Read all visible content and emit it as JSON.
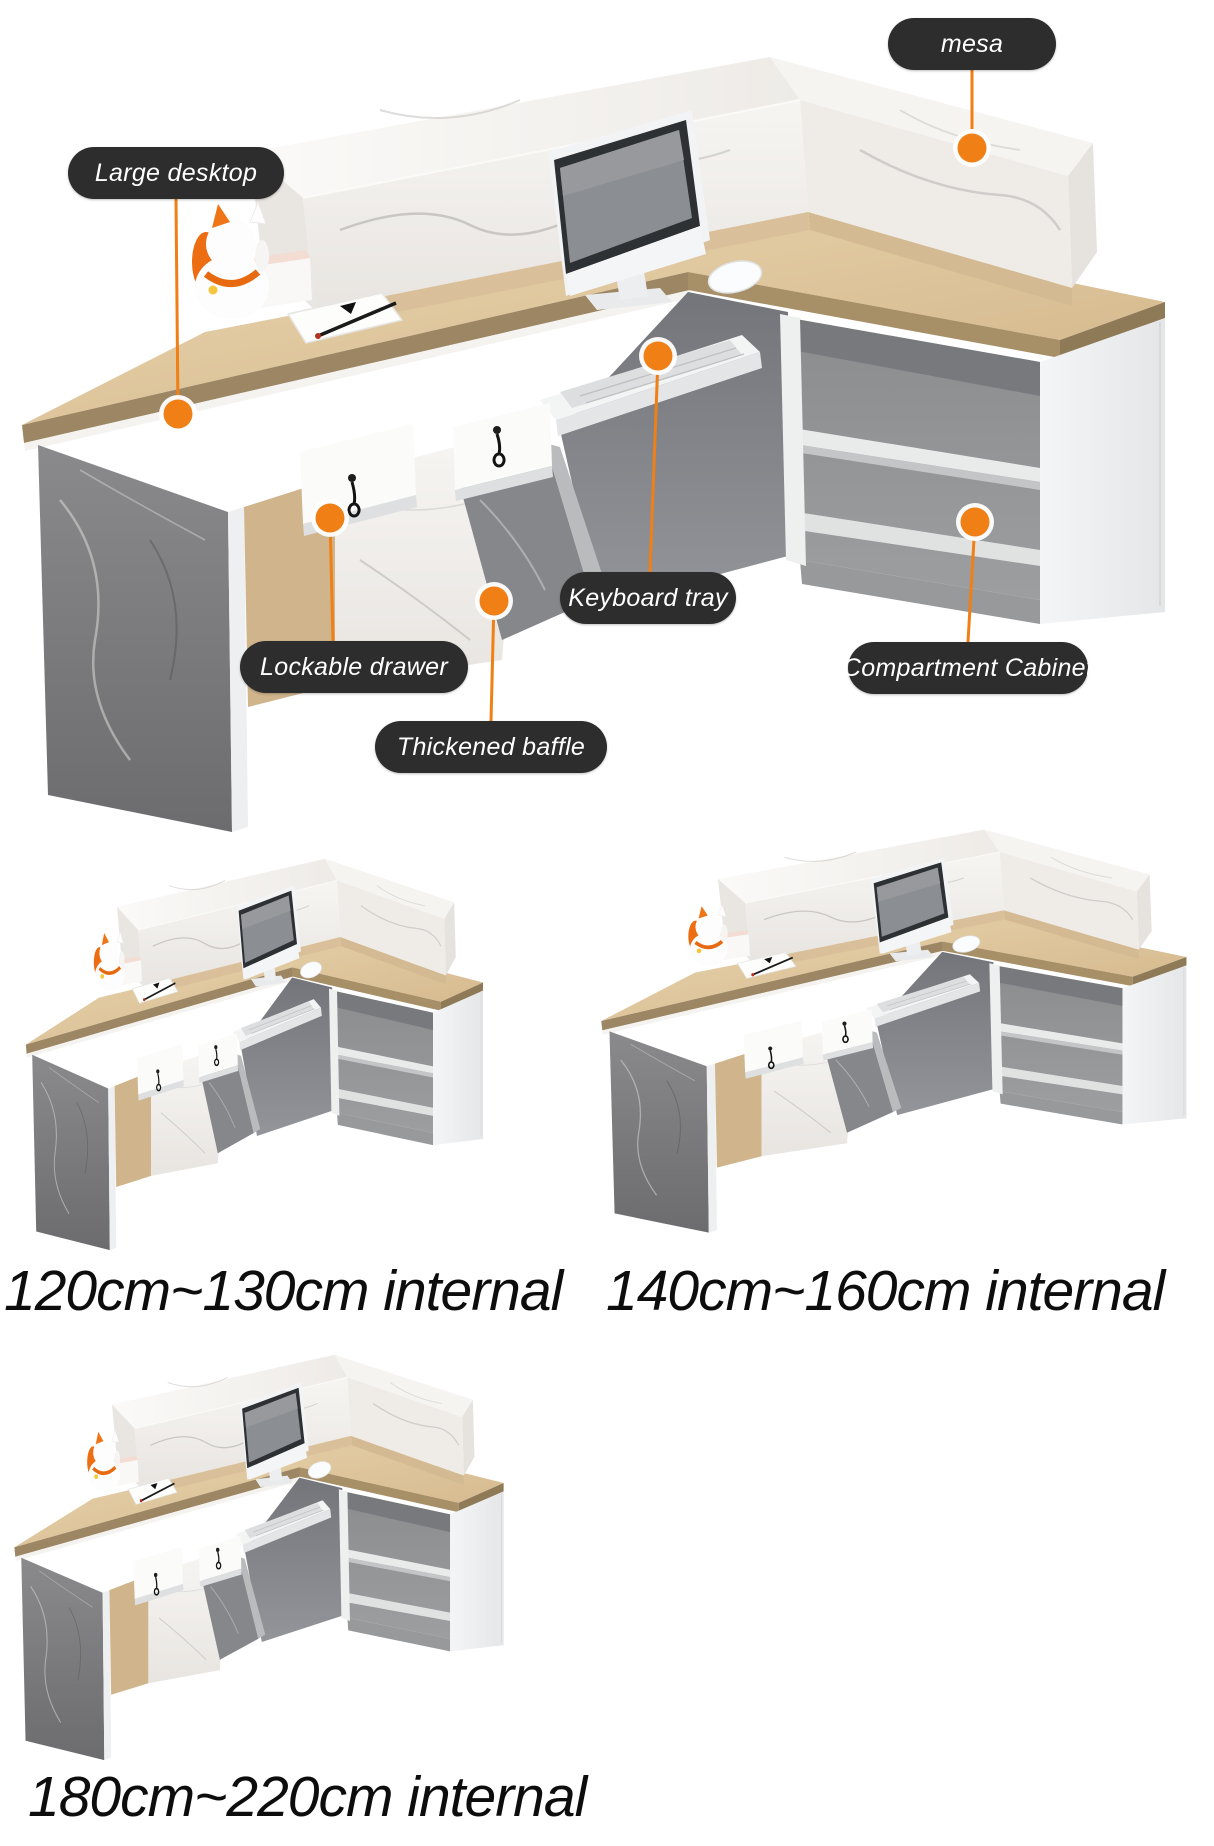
{
  "colors": {
    "accent_orange": "#f07f16",
    "pill_background": "#2d2d2d",
    "pill_text": "#ffffff",
    "caption_text": "#0d0d0d",
    "wood": "#ddc59c",
    "marble_white": "#f2f0ed",
    "marble_gray": "#7f7f7d"
  },
  "hero": {
    "callouts": [
      {
        "id": "mesa",
        "label": "mesa"
      },
      {
        "id": "large-desktop",
        "label": "Large desktop"
      },
      {
        "id": "lockable-drawer",
        "label": "Lockable drawer"
      },
      {
        "id": "keyboard-tray",
        "label": "Keyboard tray"
      },
      {
        "id": "thickened-baffle",
        "label": "Thickened baffle"
      },
      {
        "id": "compartment-cabinet",
        "label": "Compartment Cabinet"
      }
    ]
  },
  "variants": [
    {
      "id": "small",
      "caption": "120cm~130cm internal"
    },
    {
      "id": "medium",
      "caption": "140cm~160cm internal"
    },
    {
      "id": "large",
      "caption": "180cm~220cm internal"
    }
  ]
}
